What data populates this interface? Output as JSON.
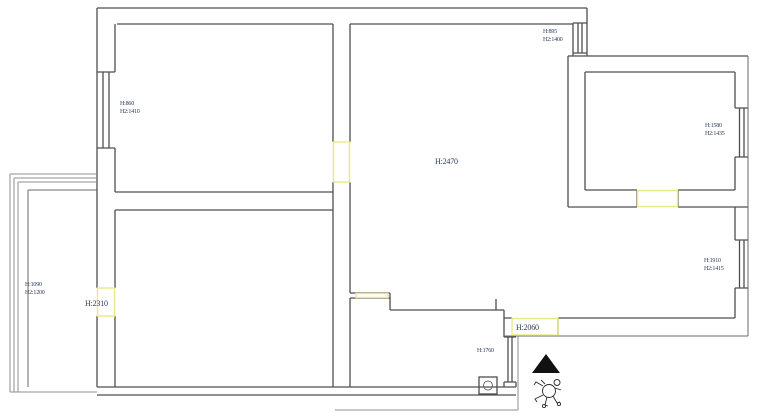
{
  "palette": {
    "wall_dark": "#4f4f4f",
    "wall_light": "#8f8f8f",
    "opening_yellow": "#e9e98a",
    "label_navy": "#2c3a55",
    "north_arrow_black": "#111111"
  },
  "plan": {
    "labels": {
      "window_bedroom1": {
        "line1": "H:860",
        "line2": "H2:1410"
      },
      "window_hall_top": {
        "line1": "H:895",
        "line2": "H2:1400"
      },
      "window_room_topright": {
        "line1": "H:1580",
        "line2": "H2:1435"
      },
      "window_corridor": {
        "line1": "H:1910",
        "line2": "H2:1415"
      },
      "window_balcony": {
        "line1": "H:1090",
        "line2": "H2:1200"
      },
      "door_balcony": "H:2310",
      "hall_height": "H:2470",
      "entry_door": "H:2060",
      "window_kitchen": "H:1760"
    },
    "symbols": {
      "north_arrow": "north-arrow",
      "figure": "figure-sketch",
      "drain": "floor-drain"
    }
  }
}
